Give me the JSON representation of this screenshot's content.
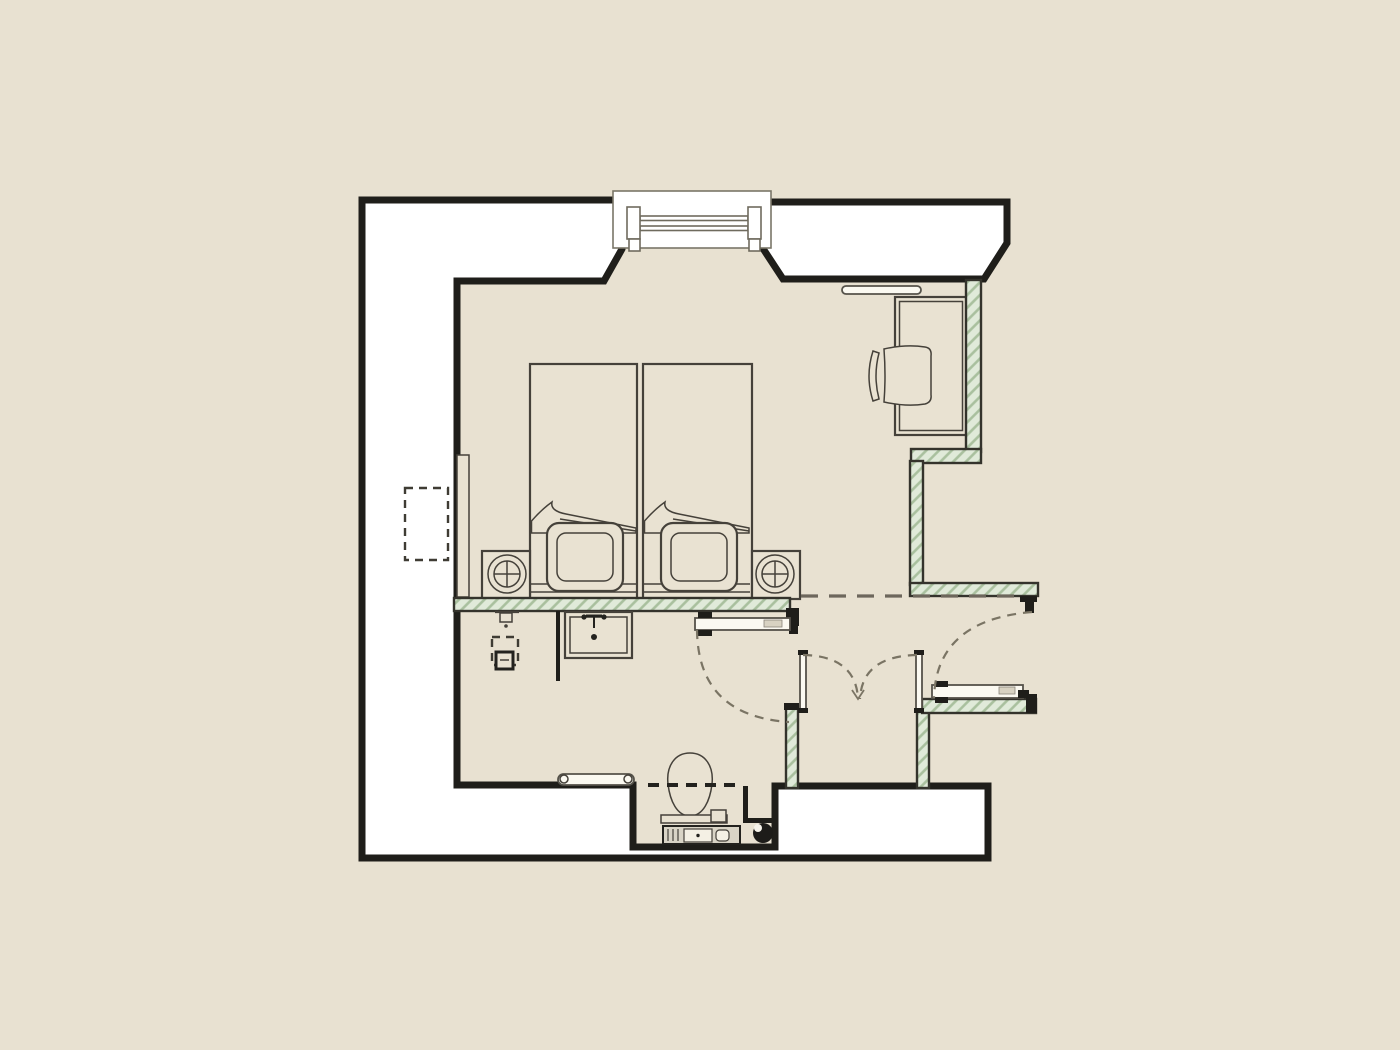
{
  "meta": {
    "type": "architectural floor plan",
    "view": "top-down plan of a hotel guest room with bedroom, bathroom zone, entry hall and shower enclosure",
    "visible_text": "none"
  },
  "colors": {
    "background": "#e8e1d1",
    "floor": "#e9e2d2",
    "wall_fill": "#ffffff",
    "wall_outline": "#1f1e1a",
    "hatch_fill": "#e0ead9",
    "hatch_line": "#a9c09e",
    "hatch_outline": "#34332c",
    "line": "#45413a",
    "leaf_fill": "#fbf9f1",
    "dash": "#7a7464",
    "dash_dark": "#23221e",
    "drain": "#1d1c19",
    "cistern": "#d9d4c6",
    "label_chip": "#d8d2c2"
  },
  "rooms": [
    {
      "name": "bedroom"
    },
    {
      "name": "bathroom"
    },
    {
      "name": "entry-hall"
    },
    {
      "name": "shower-enclosure"
    },
    {
      "name": "toilet-niche"
    }
  ],
  "elements": {
    "window": "window with splayed wall reveals, top center",
    "beds": [
      "twin bed left",
      "twin bed right"
    ],
    "pillows": 2,
    "nightstands": 2,
    "table_lamps": 2,
    "desk": "desk with task chair against right wall",
    "shelf": "wall shelf above desk",
    "bench": "slim bench along left wall",
    "service_niche": "dashed recess in left wall",
    "sink": "vanity sink on headboard wall",
    "wall_light": "small wall fixture left of sink",
    "outlet_box": "floor box with dashed clearance square",
    "partition": "short counter partition below sink",
    "toilet": "toilet with cistern in niche",
    "grab_bar": "grab bar left of toilet",
    "floor_drain": "floor drain right of toilet",
    "doors": [
      "bathroom swing door",
      "entry swing door",
      "double swing shower doors"
    ],
    "overhead": "dashed bulkhead line across entry opening"
  }
}
